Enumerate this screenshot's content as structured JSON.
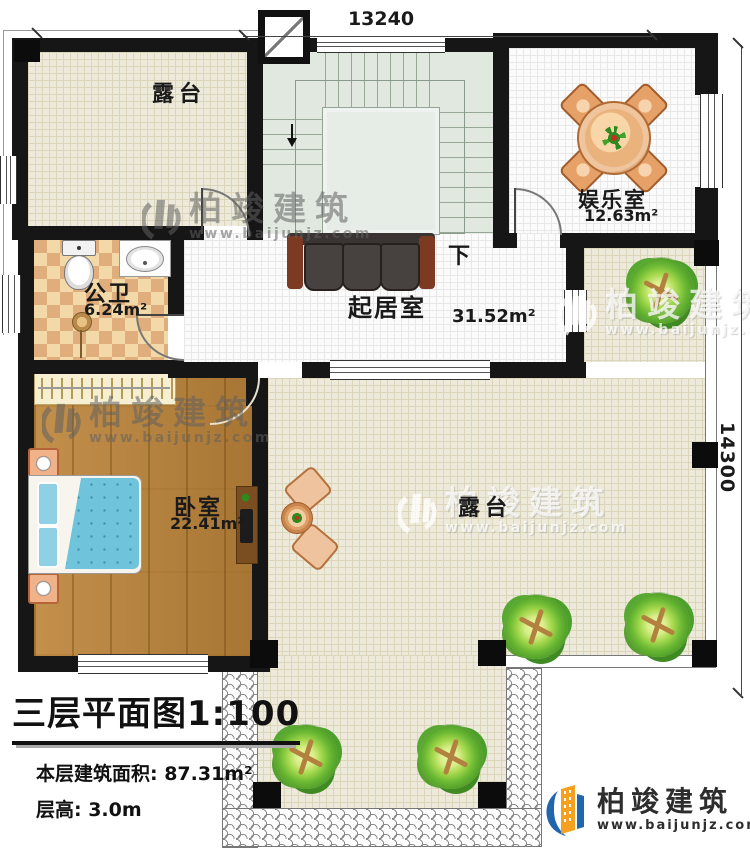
{
  "dimensions": {
    "top": "13240",
    "right": "14300"
  },
  "rooms": {
    "terrace_top": {
      "label": "露台"
    },
    "entertainment": {
      "label": "娱乐室",
      "area": "12.63m²"
    },
    "bathroom": {
      "label": "公卫",
      "area": "6.24m²"
    },
    "living": {
      "label": "起居室",
      "area": "31.52m²"
    },
    "bedroom": {
      "label": "卧室",
      "area": "22.41m²"
    },
    "terrace_right": {
      "label": "露台"
    },
    "stairs": {
      "down_label": "下"
    }
  },
  "title_block": {
    "title": "三层平面图",
    "scale": "1:100",
    "area_line": "本层建筑面积: 87.31m²",
    "height_line": "层高: 3.0m"
  },
  "branding": {
    "name": "柏竣建筑",
    "url": "www.baijunjz.com"
  },
  "watermark": {
    "name": "柏竣建筑",
    "url": "www.baijunjz.com"
  },
  "colors": {
    "wall": "#161616",
    "terrace_floor": "#edeadb",
    "room_floor": "#fbfbfb",
    "stair_floor": "#e0e8e0",
    "wood_floor": "#b5813b",
    "tile_light": "#f3d9a7",
    "tile_dark": "#dfae7c",
    "brand_blue": "#1f66ad",
    "brand_orange": "#f5a01e"
  }
}
